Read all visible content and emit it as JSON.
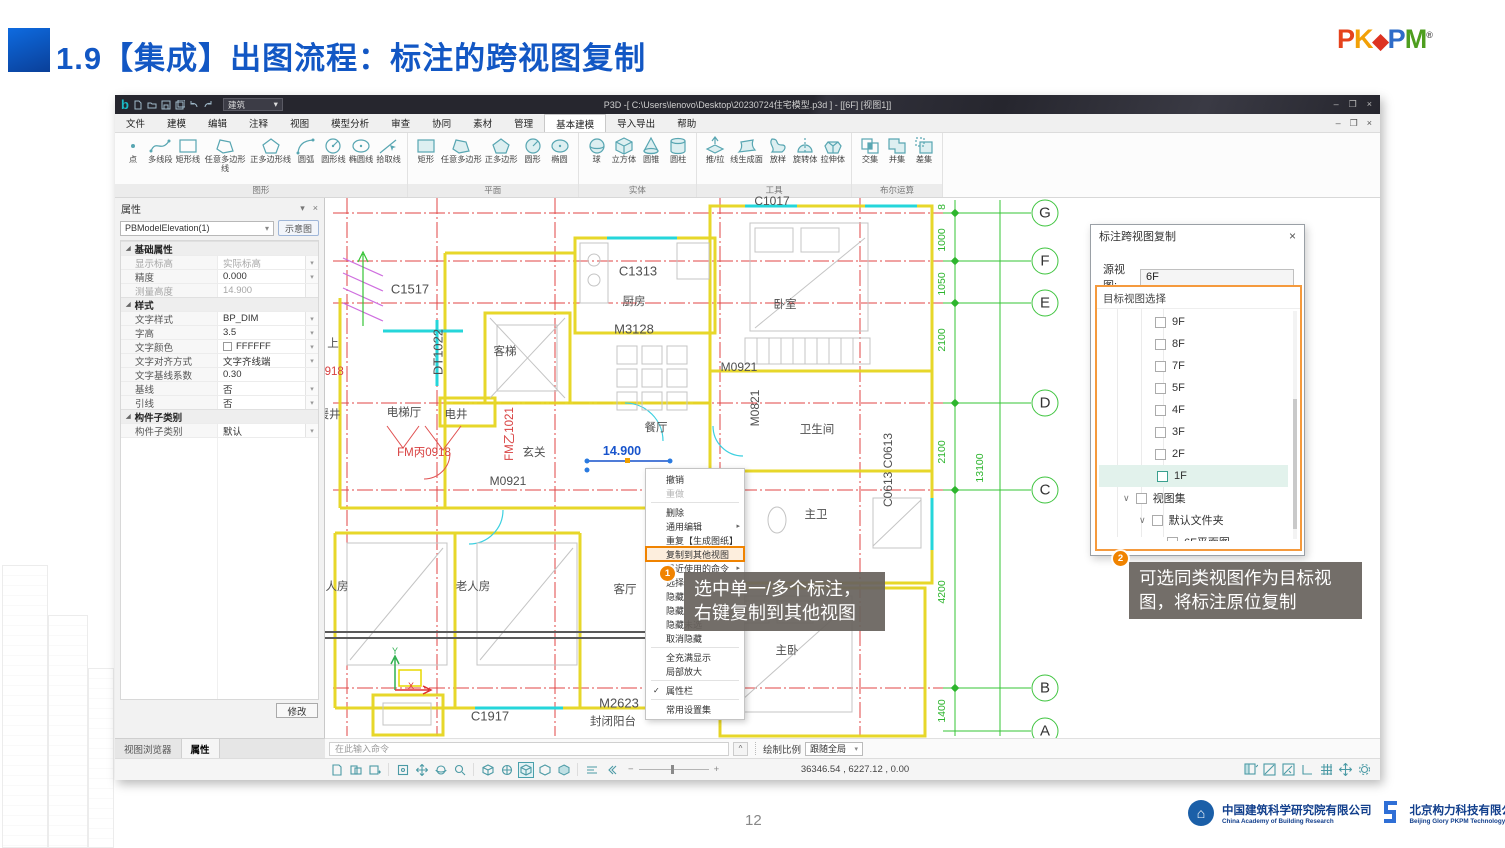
{
  "slide": {
    "title": "1.9【集成】出图流程：标注的跨视图复制",
    "page_number": "12"
  },
  "logo": {
    "p1": "P",
    "k": "K",
    "diamond": "◆",
    "p2": "P",
    "m": "M",
    "registered": "®"
  },
  "titlebar": {
    "mode": "建筑",
    "title": "P3D -[ C:\\Users\\lenovo\\Desktop\\20230724住宅模型.p3d ] - [[6F] [视图1]]",
    "minimize": "–",
    "restore": "❐",
    "close": "×"
  },
  "menubar": {
    "items": [
      "文件",
      "建模",
      "编辑",
      "注释",
      "视图",
      "模型分析",
      "审查",
      "协同",
      "素材",
      "管理",
      "基本建模",
      "导入导出",
      "帮助"
    ]
  },
  "ribbon": {
    "groups": [
      {
        "label": "图形",
        "tools": [
          "点",
          "多线段",
          "矩形线",
          "任意多边形线",
          "正多边形线",
          "圆弧",
          "圆形线",
          "椭圆线",
          "拾取线"
        ]
      },
      {
        "label": "平面",
        "tools": [
          "矩形",
          "任意多边形",
          "正多边形",
          "圆形",
          "椭圆"
        ]
      },
      {
        "label": "实体",
        "tools": [
          "球",
          "立方体",
          "圆锥",
          "圆柱"
        ]
      },
      {
        "label": "工具",
        "tools": [
          "推/拉",
          "线生成面",
          "放样",
          "旋转体",
          "拉伸体"
        ]
      },
      {
        "label": "布尔运算",
        "tools": [
          "交集",
          "并集",
          "差集"
        ]
      }
    ]
  },
  "props": {
    "title": "属性",
    "selector": "PBModelElevation(1)",
    "preview": "示意图",
    "sections": [
      {
        "header": "基础属性",
        "rows": [
          {
            "label": "显示标高",
            "value": "实际标高"
          },
          {
            "label": "精度",
            "value": "0.000"
          },
          {
            "label": "测量高度",
            "value": "14.900"
          }
        ]
      },
      {
        "header": "样式",
        "rows": [
          {
            "label": "文字样式",
            "value": "BP_DIM"
          },
          {
            "label": "字高",
            "value": "3.5"
          },
          {
            "label": "文字颜色",
            "value": "FFFFFF"
          },
          {
            "label": "文字对齐方式",
            "value": "文字齐线端"
          },
          {
            "label": "文字基线系数",
            "value": "0.30"
          },
          {
            "label": "基线",
            "value": "否"
          },
          {
            "label": "引线",
            "value": "否"
          }
        ]
      },
      {
        "header": "构件子类别",
        "rows": [
          {
            "label": "构件子类别",
            "value": "默认"
          }
        ]
      }
    ],
    "modify": "修改",
    "tabs": [
      "视图浏览器",
      "属性"
    ]
  },
  "canvas": {
    "grid_letters": [
      "G",
      "F",
      "E",
      "D",
      "C",
      "B",
      "A"
    ],
    "dims": [
      "8",
      "1000",
      "1050",
      "2100",
      "2100",
      "4200",
      "1400",
      "13100"
    ],
    "rooms": [
      "客梯",
      "厨房",
      "卧室",
      "电梯厅",
      "电井",
      "玄关",
      "餐厅",
      "卫生间",
      "主卫",
      "主卧",
      "人房",
      "老人房",
      "客厅",
      "封闭阳台",
      "上",
      "暖井"
    ],
    "tags": [
      "C1517",
      "C1313",
      "M3128",
      "DT1022",
      "M0921",
      "M0921",
      "M0821",
      "C0613 C0613",
      "C1917",
      "M2623",
      "C1017"
    ],
    "red_tags": [
      "FM丙0918",
      "FM乙1021",
      "0918"
    ],
    "selected_dim": "14.900",
    "axis": {
      "x": "X",
      "y": "Y"
    }
  },
  "context_menu": {
    "items": [
      "撤销",
      "重做",
      "删除",
      "通用编辑",
      "重复【生成图纸】",
      "复制到其他视图",
      "最近使用的命令",
      "选择",
      "隐藏",
      "隐藏",
      "隐藏未选",
      "取消隐藏",
      "全充满显示",
      "局部放大",
      "属性栏",
      "常用设置集"
    ],
    "check": "✓"
  },
  "callouts": {
    "c1": {
      "badge": "1",
      "line1": "选中单一/多个标注，",
      "line2": "右键复制到其他视图"
    },
    "c2": {
      "badge": "2",
      "line1": "可选同类视图作为目标视",
      "line2": "图，将标注原位复制"
    }
  },
  "dialog": {
    "title": "标注跨视图复制",
    "close": "×",
    "source_label": "源视图:",
    "source_value": "6F",
    "target_label": "目标视图选择",
    "items": [
      "9F",
      "8F",
      "7F",
      "5F",
      "4F",
      "3F",
      "2F",
      "1F"
    ],
    "set_node": "视图集",
    "folder_node": "默认文件夹",
    "leaf_node": "6F平面图",
    "accent_color": "#f59a3d"
  },
  "commandbar": {
    "placeholder": "在此输入命令",
    "scale_label": "绘制比例",
    "scale_value": "跟随全局"
  },
  "statusbar": {
    "coordinates": "36346.54 , 6227.12 , 0.00"
  },
  "footer": {
    "org1_cn": "中国建筑科学研究院有限公司",
    "org1_en": "China Academy of Building Research",
    "org2_cn": "北京构力科技有限公司",
    "org2_en": "Beijing Glory PKPM Technology Co.,Ltd."
  }
}
